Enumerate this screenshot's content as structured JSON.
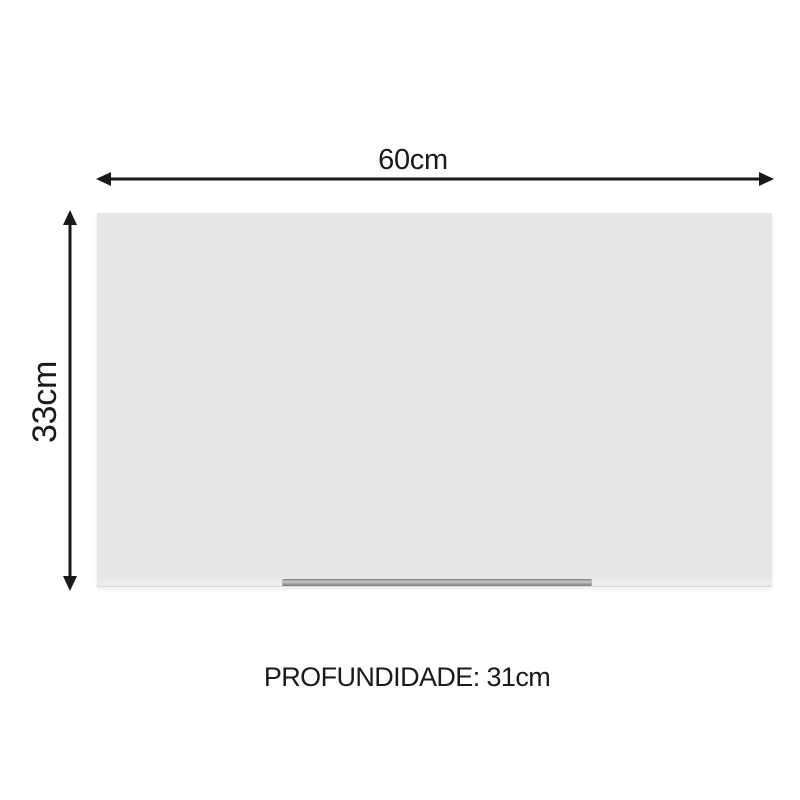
{
  "diagram": {
    "title": "product-dimension-diagram",
    "width_label": "60cm",
    "height_label": "33cm",
    "depth_label": "PROFUNDIDADE: 31cm",
    "colors": {
      "background": "#ffffff",
      "arrow": "#1a1a1a",
      "text": "#1a1a1a",
      "cabinet_fill": "#e6e6e6",
      "cabinet_edge": "#d8d8d8",
      "handle_light": "#c6c6c6",
      "handle_dark": "#7a7a7a"
    }
  }
}
